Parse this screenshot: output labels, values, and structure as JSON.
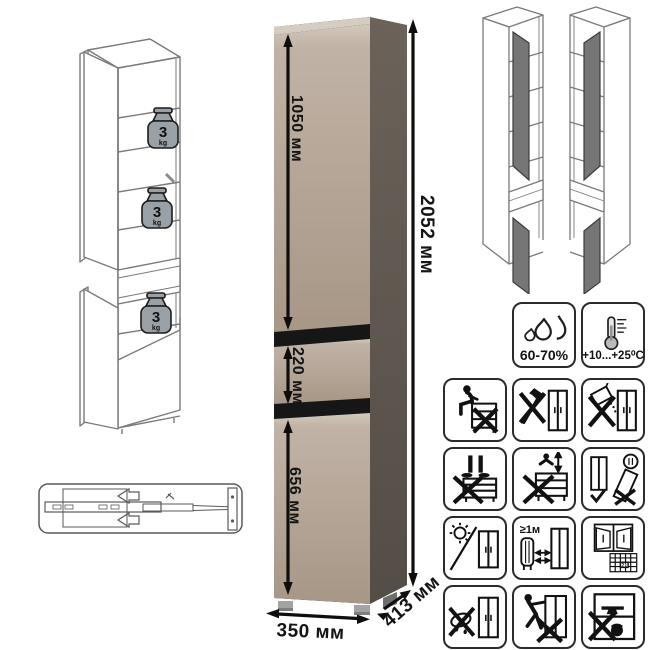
{
  "dimensions": {
    "total_height": "2052 мм",
    "upper_door_height": "1050 мм",
    "drawer_height": "220 мм",
    "lower_door_height": "656 мм",
    "width": "350 мм",
    "depth": "413 мм"
  },
  "shelf_load": {
    "value": "3",
    "unit": "kg"
  },
  "climate": {
    "humidity": "60-70%",
    "temperature": "+10...+25⁰C"
  },
  "warnings": {
    "min_distance_from_heat": "≥1м",
    "ventilation_calendar_day": "21"
  },
  "colors": {
    "cabinet_front": "#b5a697",
    "cabinet_side": "#5f574e",
    "panel_gap": "#161616",
    "wireframe_stroke": "#7a7a7a",
    "pictogram_stroke": "#111111"
  },
  "icons": [
    {
      "name": "open-cabinet-wireframe",
      "meaning": "internal layout with shelf load limits"
    },
    {
      "name": "drawer-slide-diagram",
      "meaning": "telescopic ball-bearing drawer slide"
    },
    {
      "name": "mirrored-assembly-options",
      "meaning": "door can be hinged left or right"
    },
    {
      "name": "humidity-icon",
      "meaning": "allowed air humidity 60-70%"
    },
    {
      "name": "temperature-icon",
      "meaning": "allowed temperature +10...+25⁰C"
    },
    {
      "name": "no-sitting-icon",
      "meaning": "do not sit on furniture"
    },
    {
      "name": "no-sharp-tools-icon",
      "meaning": "do not strike with sharp tools"
    },
    {
      "name": "no-abrasives-icon",
      "meaning": "do not use abrasive powders"
    },
    {
      "name": "no-standing-icon",
      "meaning": "do not stand on furniture"
    },
    {
      "name": "no-jumping-icon",
      "meaning": "do not jump on furniture"
    },
    {
      "name": "transport-upright-icon",
      "meaning": "transport and store upright only"
    },
    {
      "name": "avoid-sunlight-icon",
      "meaning": "keep away from direct sunlight"
    },
    {
      "name": "heater-distance-icon",
      "meaning": "keep at least 1 m from heat sources"
    },
    {
      "name": "ventilate-room-icon",
      "meaning": "ventilate the room regularly"
    },
    {
      "name": "no-wet-cleaning-icon",
      "meaning": "do not clean with wet cloth"
    },
    {
      "name": "no-dragging-icon",
      "meaning": "do not drag when moving"
    },
    {
      "name": "no-overload-icon",
      "meaning": "do not overload with heavy items"
    }
  ]
}
